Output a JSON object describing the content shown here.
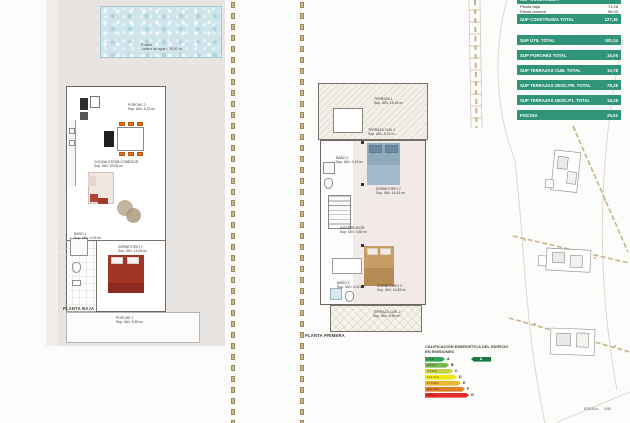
{
  "sheet": {
    "scale_label": "ESCALA 1/50"
  },
  "summary_table": {
    "accent_color": "#2f9478",
    "header": "SUP CONSTRUIDA",
    "rows": [
      {
        "label": "Planta baja",
        "value": "71,28"
      },
      {
        "label": "Planta primera",
        "value": "56,02"
      }
    ],
    "totals": [
      {
        "label": "SUP CONSTRUIDA TOTAL",
        "value": "127,30"
      },
      {
        "label": "SUP ÚTIL TOTAL",
        "value": "100,24"
      },
      {
        "label": "SUP PORCHES TOTAL",
        "value": "16,05"
      },
      {
        "label": "SUP TERRAZAS CUB. TOTAL",
        "value": "10,78"
      },
      {
        "label": "SUP TERRAZAS DESC.PB. TOTAL",
        "value": "78,38"
      },
      {
        "label": "SUP TERRAZAS DESC.P1. TOTAL",
        "value": "18,28"
      },
      {
        "label": "PISCINA",
        "value": "25,92"
      }
    ]
  },
  "ground_floor": {
    "title": "PLANTA BAJA",
    "pool": {
      "label": "Piscina",
      "area": "Lámina de agua = 25,92 m²"
    },
    "rooms": {
      "porche2": {
        "label": "PORCHE 2",
        "area": "Sup. Útil= 6,22 m²"
      },
      "cocina": {
        "label": "COCINA-ESTAR-COMEDOR",
        "area": "Sup. Útil= 39,05 m²"
      },
      "bano1": {
        "label": "BAÑO 1",
        "area": "Sup. Útil= 4,05 m²"
      },
      "dormitorio1": {
        "label": "DORMITORIO 1",
        "area": "Sup. Útil= 14,05 m²"
      },
      "porche1": {
        "label": "PORCHE 1",
        "area": "Sup. Útil= 9,83 m²"
      }
    }
  },
  "first_floor": {
    "title": "PLANTA PRIMERA",
    "rooms": {
      "terraza1": {
        "label": "TERRAZA 1",
        "area": "Sup. Útil= 18,28 m²"
      },
      "terrazacub1": {
        "label": "TERRAZA CUB. 1",
        "area": "Sup. Útil= 5,23 m²"
      },
      "bano2": {
        "label": "BAÑO 2",
        "area": "Sup. Útil= 4,23 m²"
      },
      "dormitorio2": {
        "label": "DORMITORIO 2",
        "area": "Sup. Útil= 16,13 m²"
      },
      "distribuidor": {
        "label": "DISTRIBUIDOR",
        "area": "Sup. Útil= 3,80 m²"
      },
      "bano3": {
        "label": "BAÑO 3",
        "area": "Sup. Útil= 4,02 m²"
      },
      "dormitorio3": {
        "label": "DORMITORIO 3",
        "area": "Sup. Útil= 14,83 m²"
      },
      "terrazacub2": {
        "label": "TERRAZA CUB. 2",
        "area": "Sup. Útil= 5,55 m²"
      }
    }
  },
  "energy_chart": {
    "type": "bar",
    "title_line1": "CALIFICACIÓN ENERGÉTICA DEL EDIFICIO",
    "title_line2": "EN EMISIONES",
    "bars": [
      {
        "letter": "A",
        "range": "< 4,6",
        "color": "#33a357"
      },
      {
        "letter": "B",
        "range": "4,6-7,5",
        "color": "#79b752"
      },
      {
        "letter": "C",
        "range": "7,5-11,6",
        "color": "#c3d545"
      },
      {
        "letter": "D",
        "range": "11,6-17,9",
        "color": "#f4e70f"
      },
      {
        "letter": "E",
        "range": "17,9-36,2",
        "color": "#edb731"
      },
      {
        "letter": "F",
        "range": "36,2-45,2",
        "color": "#e07d26"
      },
      {
        "letter": "G",
        "range": "≥ 45,2",
        "color": "#e52d29"
      }
    ],
    "rating": {
      "letter": "A",
      "color": "#1b7a43"
    }
  }
}
